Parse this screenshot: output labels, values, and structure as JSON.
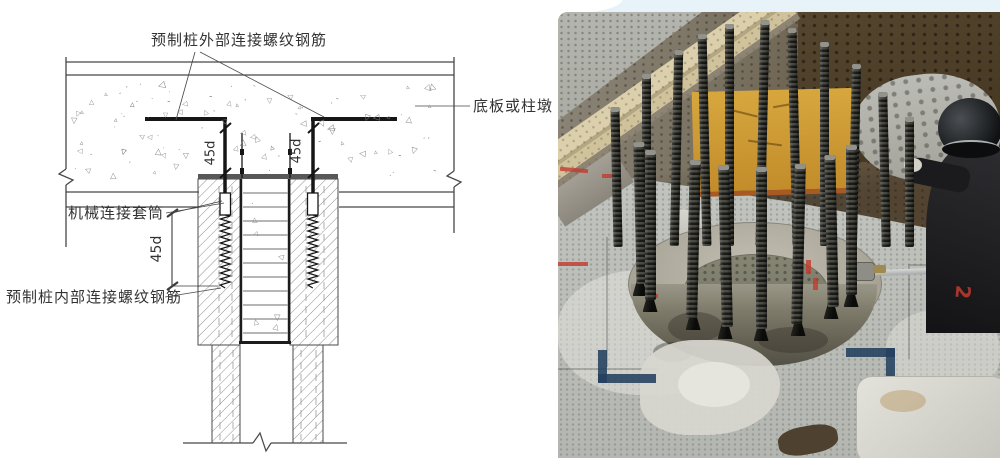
{
  "page": {
    "bg": "#ffffff",
    "top_strip": "#e7f3f9"
  },
  "diagram": {
    "labels": {
      "external_rebar": "预制桩外部连接螺纹钢筋",
      "slab_or_pier": "底板或柱墩",
      "sleeve": "机械连接套筒",
      "internal_rebar": "预制桩内部连接螺纹钢筋",
      "dim_hook_left": "45d",
      "dim_hook_right": "45d",
      "dim_splice": "45d"
    },
    "colors": {
      "line": "#474747",
      "bar": "#161616",
      "hatch": "#8f8f8f",
      "text": "#333333",
      "pile_band": "#585858"
    }
  },
  "photo": {
    "red_mark_text": "2",
    "colors": {
      "pavement": "#bdbfba",
      "soil_dark": "#4e3f2d",
      "gravel": "#aeafa8",
      "rubble": "#b5b5af",
      "plank": "#d3c49c",
      "board": "#cc9833",
      "cap_rim": "#b3afa3",
      "cap_core": "#7f7d70",
      "cap_front": "#7d7a6b",
      "rod": "#23221f",
      "coupler": "#101010",
      "helmet": "#16181a",
      "jacket": "#232327",
      "wrench": "#c3c6c6",
      "blue_mark": "#23405e",
      "red_mark": "#c23b2e",
      "bag": "#d8d7d0"
    },
    "rods": {
      "back": [
        [
          54,
          95,
          140
        ],
        [
          84,
          62,
          172
        ],
        [
          114,
          38,
          196
        ],
        [
          142,
          22,
          212
        ],
        [
          167,
          12,
          222
        ],
        [
          200,
          8,
          226
        ],
        [
          232,
          16,
          218
        ],
        [
          262,
          30,
          204
        ],
        [
          292,
          52,
          182
        ],
        [
          322,
          80,
          155
        ],
        [
          347,
          105,
          130
        ]
      ],
      "front": [
        [
          77,
          130,
          142
        ],
        [
          87,
          138,
          150
        ],
        [
          130,
          148,
          158
        ],
        [
          162,
          153,
          162
        ],
        [
          198,
          155,
          162
        ],
        [
          235,
          152,
          160
        ],
        [
          268,
          143,
          152
        ],
        [
          288,
          133,
          150
        ]
      ]
    }
  }
}
